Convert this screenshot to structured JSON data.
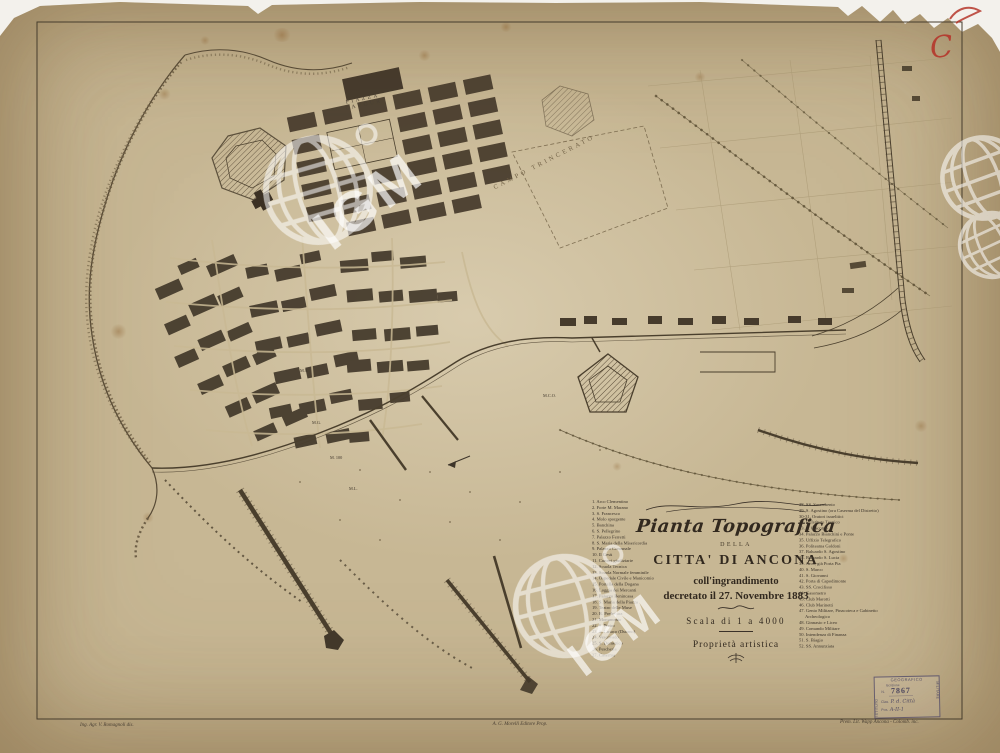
{
  "palette": {
    "paper": "#c7b794",
    "ink": "#3b332a",
    "map_line": "#4a3f2d",
    "red_mark": "#b5372c",
    "stamp": "#565064",
    "watermark": "#ffffff"
  },
  "title_block": {
    "title": "Pianta Topografica",
    "della": "DELLA",
    "city": "CITTA' DI ANCONA",
    "line1": "coll'ingrandimento",
    "line2": "decretato il 27. Novembre 1883",
    "scale": "Scala di 1 a 4000",
    "artistic": "Proprietà artistica"
  },
  "legend_left": [
    {
      "n": "1.",
      "t": "Arco Clementino"
    },
    {
      "n": "2.",
      "t": "Forte M. Marano"
    },
    {
      "n": "3.",
      "t": "S. Francesco"
    },
    {
      "n": "4.",
      "t": "Molo sporgente"
    },
    {
      "n": "5.",
      "t": "Banchina"
    },
    {
      "n": "6.",
      "t": "S. Pellegrino"
    },
    {
      "n": "7.",
      "t": "Palazzo Ferretti"
    },
    {
      "n": "8.",
      "t": "S. Maria della Misericordia"
    },
    {
      "n": "9.",
      "t": "Palazzo Comunale"
    },
    {
      "n": "10.",
      "t": "Il Gesù"
    },
    {
      "n": "11.",
      "t": "Carceri giudiziarie"
    },
    {
      "n": "12.",
      "t": "Scuola Tecnica"
    },
    {
      "n": "13.",
      "t": "Scuola Normale femminile"
    },
    {
      "n": "14.",
      "t": "Ospedale Civile e Manicomio"
    },
    {
      "n": "15.",
      "t": "Portella della Dogana"
    },
    {
      "n": "16.",
      "t": "Loggia dei Mercanti"
    },
    {
      "n": "17.",
      "t": "Palazzo Benincasa"
    },
    {
      "n": "18.",
      "t": "S. Maria della Piazza"
    },
    {
      "n": "19.",
      "t": "Teatro delle Muse"
    },
    {
      "n": "20.",
      "t": "R. Prefettura"
    },
    {
      "n": "21.",
      "t": "Monumento"
    },
    {
      "n": "22.",
      "t": "S. Pietro"
    },
    {
      "n": "23.",
      "t": "S. Ciriaco (Duomo)"
    },
    {
      "n": "24.",
      "t": "Vescovado"
    },
    {
      "n": "25.",
      "t": "S. Domenico"
    },
    {
      "n": "26.",
      "t": "Pescheria"
    },
    {
      "n": "27.",
      "t": "Caserma"
    }
  ],
  "legend_right": [
    {
      "n": "28.",
      "t": "SS. Sacramento"
    },
    {
      "n": "29.",
      "t": "S. Agostino (ora Caserma del Distretto)"
    },
    {
      "n": "30-31.",
      "t": "Oratori israelitici"
    },
    {
      "n": "32.",
      "t": "R. Istituto Tecnico"
    },
    {
      "n": "33.",
      "t": "S. Giacomo"
    },
    {
      "n": "34.",
      "t": "Palazzo Bianchini e Ponte"
    },
    {
      "n": "35.",
      "t": "Uffizio Telegrafico"
    },
    {
      "n": "36.",
      "t": "Politeama Goldoni"
    },
    {
      "n": "37.",
      "t": "Baluardo S. Agostino"
    },
    {
      "n": "38.",
      "t": "Baluardo S. Lucia"
    },
    {
      "n": "39.",
      "t": "Arco, già Porta Pia"
    },
    {
      "n": "40.",
      "t": "S. Marco"
    },
    {
      "n": "41.",
      "t": "S. Giovanni"
    },
    {
      "n": "42.",
      "t": "Porta di Capodimonte"
    },
    {
      "n": "43.",
      "t": "SS. Crocifisso"
    },
    {
      "n": "44.",
      "t": "Gasometro"
    },
    {
      "n": "45.",
      "t": "Club Marotti"
    },
    {
      "n": "46.",
      "t": "Club Marinetti"
    },
    {
      "n": "47.",
      "t": "Genio Militare, Pinacoteca e Gabinetto Archeologico"
    },
    {
      "n": "48.",
      "t": "Ginnasio e Liceo"
    },
    {
      "n": "49.",
      "t": "Comando Militare"
    },
    {
      "n": "50.",
      "t": "Intendenza di Finanza"
    },
    {
      "n": "51.",
      "t": "S. Biagio"
    },
    {
      "n": "52.",
      "t": "SS. Annunziata"
    }
  ],
  "map_labels": {
    "piazza_line1": "PIAZZA",
    "piazza_line2": "CAVOUR",
    "campo": "CAMPO TRINCERATO",
    "piers": [
      "M.S.",
      "M.G.",
      "M. 100",
      "M.L.",
      "M.C.O."
    ]
  },
  "imprints": {
    "left": "Ing. Agr. V. Romagnoli dis.",
    "center": "A. G. Morelli  Editore Prop.",
    "right": "Prem. Lit. Wapp Ancona - Colomb. inc."
  },
  "stamp": {
    "top": "GEOGRAFICO",
    "left": "ISTITUTO",
    "right": "MILITARE",
    "row1": "Iscrizione",
    "n_label": "N.",
    "number": "7867",
    "clas_label": "Clas.",
    "clas_value": "P. d. Città",
    "pos_label": "Pos.",
    "pos_value": "A-II-1"
  },
  "watermark": {
    "label": "IGM"
  },
  "annotations": {
    "red_letter": "C"
  }
}
